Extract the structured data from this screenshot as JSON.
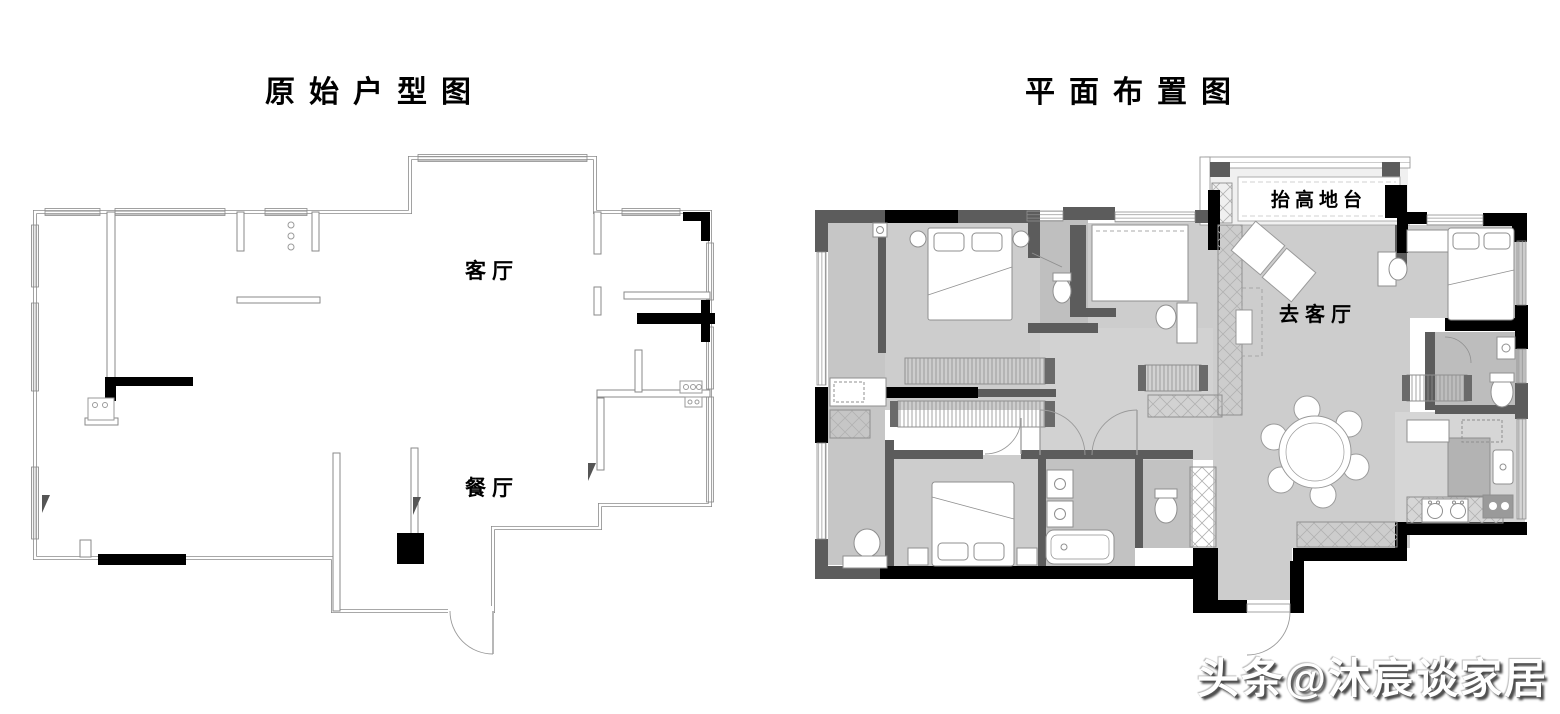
{
  "colors": {
    "wall_black": "#000000",
    "wall_gray": "#5c5c5c",
    "floor_gray": "#cdcdcd",
    "line_gray": "#8a8a8a"
  },
  "left_plan": {
    "title": "原始户型图",
    "labels": {
      "living_room": "客厅",
      "dining_room": "餐厅"
    }
  },
  "right_plan": {
    "title": "平面布置图",
    "labels": {
      "platform": "抬高地台",
      "to_living_room": "去客厅"
    }
  },
  "watermark": {
    "text": "头条@沐宸谈家居"
  }
}
